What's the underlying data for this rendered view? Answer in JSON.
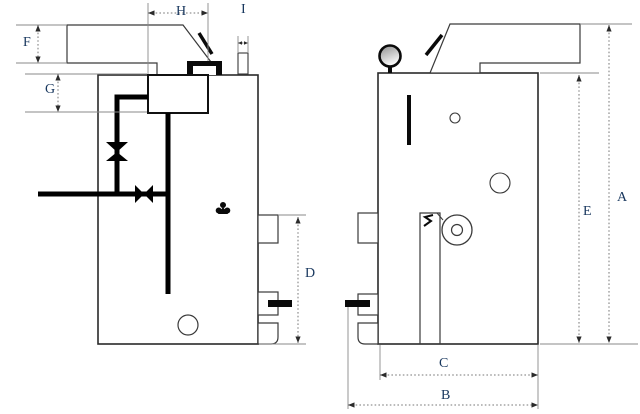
{
  "diagram": {
    "description": "boiler two-view dimensional drawing",
    "dimension_labels": {
      "A": "A",
      "B": "B",
      "C": "C",
      "D": "D",
      "E": "E",
      "F": "F",
      "G": "G",
      "H": "H",
      "I": "I"
    }
  },
  "colors": {
    "label_text": "#17365D",
    "outline": "#3a3a3a",
    "body_outline": "#2a2a2a",
    "pipe": "#000000",
    "dimension_line": "#7a7a7a",
    "background": "#ffffff"
  }
}
